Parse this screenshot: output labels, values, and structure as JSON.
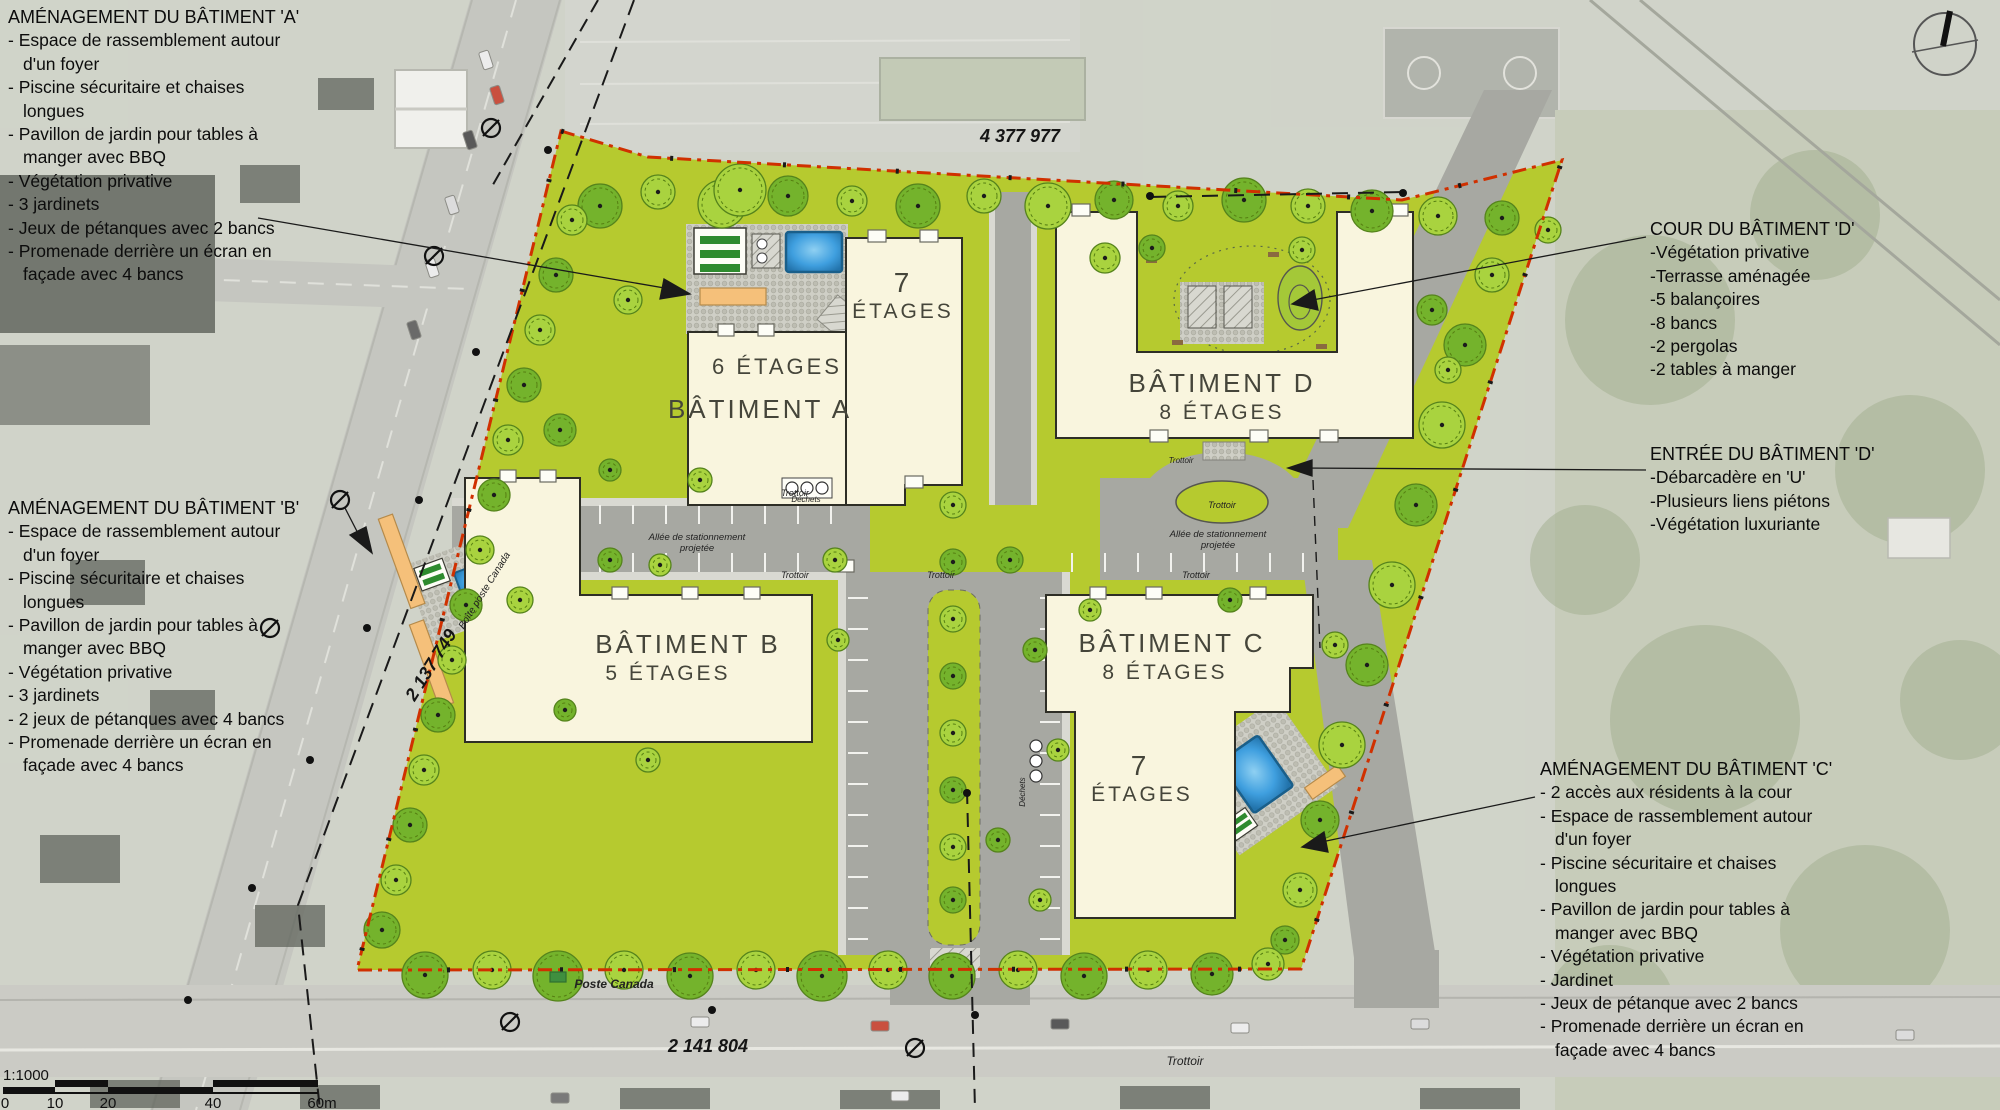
{
  "annotations": {
    "batiment_a": {
      "title": "AMÉNAGEMENT DU BÂTIMENT 'A'",
      "items": [
        "- Espace de rassemblement autour d'un foyer",
        "- Piscine sécuritaire et chaises longues",
        "- Pavillon de jardin pour tables à manger avec BBQ",
        "- Végétation privative",
        "- 3 jardinets",
        "- Jeux de pétanques avec 2 bancs",
        "- Promenade derrière un écran en façade avec 4 bancs"
      ]
    },
    "batiment_b": {
      "title": "AMÉNAGEMENT DU BÂTIMENT 'B'",
      "items": [
        "- Espace de rassemblement autour d'un foyer",
        "- Piscine sécuritaire et chaises longues",
        "- Pavillon de jardin pour tables à manger avec BBQ",
        "- Végétation privative",
        "- 3 jardinets",
        "- 2 jeux de pétanques avec 4 bancs",
        "- Promenade derrière un écran en façade avec 4 bancs"
      ]
    },
    "cour_d": {
      "title": "COUR DU BÂTIMENT 'D'",
      "items": [
        "-Végétation privative",
        "-Terrasse aménagée",
        "-5 balançoires",
        "-8 bancs",
        "-2 pergolas",
        "-2 tables à manger"
      ]
    },
    "entree_d": {
      "title": "ENTRÉE DU BÂTIMENT 'D'",
      "items": [
        "-Débarcadère en 'U'",
        "-Plusieurs liens piétons",
        "-Végétation luxuriante"
      ]
    },
    "batiment_c": {
      "title": "AMÉNAGEMENT DU BÂTIMENT 'C'",
      "items": [
        "- 2 accès aux résidents à la cour",
        "- Espace de rassemblement autour d'un foyer",
        "- Piscine sécuritaire et chaises longues",
        "- Pavillon de jardin pour tables à manger avec BBQ",
        "- Végétation privative",
        "- Jardinet",
        "- Jeux de pétanque avec 2 bancs",
        "- Promenade derrière un écran en façade avec 4 bancs"
      ]
    }
  },
  "buildings": {
    "a": {
      "name": "BÂTIMENT A",
      "floors": "6 ÉTAGES",
      "wing_num": "7",
      "wing_word": "ÉTAGES"
    },
    "b": {
      "name": "BÂTIMENT B",
      "floors": "5 ÉTAGES"
    },
    "c": {
      "name": "BÂTIMENT C",
      "floors": "8 ÉTAGES",
      "wing_num": "7",
      "wing_word": "ÉTAGES"
    },
    "d": {
      "name": "BÂTIMENT D",
      "floors": "8 ÉTAGES"
    }
  },
  "labels": {
    "lot_top": "4 377 977",
    "lot_left": "2 137 749",
    "lot_bottom": "2 141 804",
    "alley_line1": "Allée de stationnement",
    "alley_line2": "projetée",
    "sidewalk": "Trottoir",
    "waste": "Déchets",
    "post_box": "Boîte poste Canada",
    "post_office": "Poste Canada"
  },
  "scale": {
    "ratio": "1:1000",
    "ticks": [
      "0",
      "10",
      "20",
      "40",
      "60m"
    ]
  },
  "colors": {
    "site_green": "#b6ca2f",
    "building_cream": "#f9f5de",
    "road_gray": "#a7a8a2",
    "pool_blue": "#3f9fdf",
    "boundary_red": "#d03000",
    "deck_orange": "#f5c07a"
  }
}
